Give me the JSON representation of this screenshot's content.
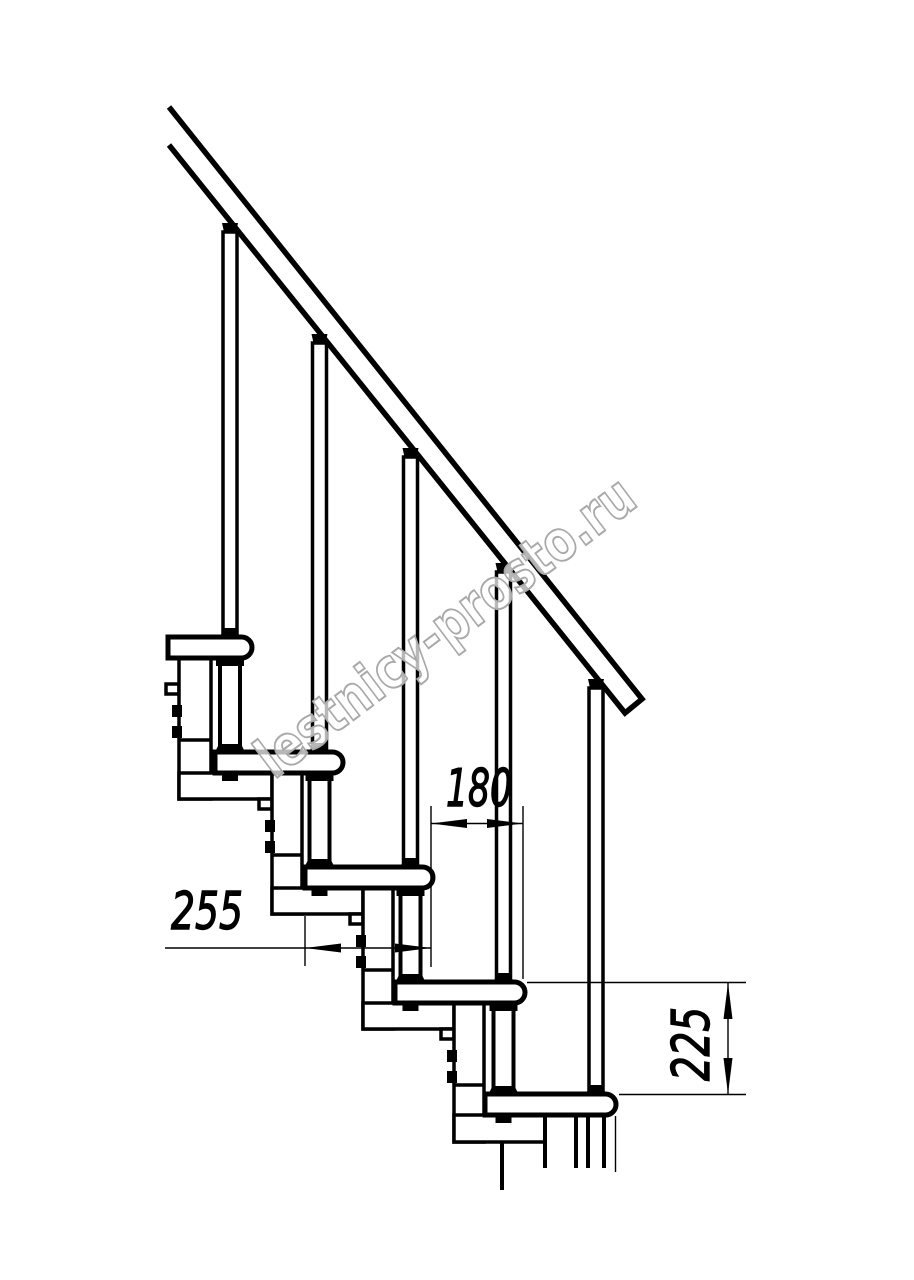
{
  "drawing": {
    "watermark": {
      "text": "lestnicy-prosto.ru",
      "color": "#a9a9a9"
    },
    "palette": {
      "line": "#000000",
      "background": "#ffffff"
    },
    "dimensions": {
      "tread_depth": {
        "value": "255",
        "orientation": "horizontal"
      },
      "step_run": {
        "value": "180",
        "orientation": "horizontal"
      },
      "step_rise": {
        "value": "225",
        "orientation": "vertical"
      }
    },
    "structure": {
      "treads": 5,
      "balusters": 5,
      "handrail": true,
      "support_modules": 5
    }
  }
}
